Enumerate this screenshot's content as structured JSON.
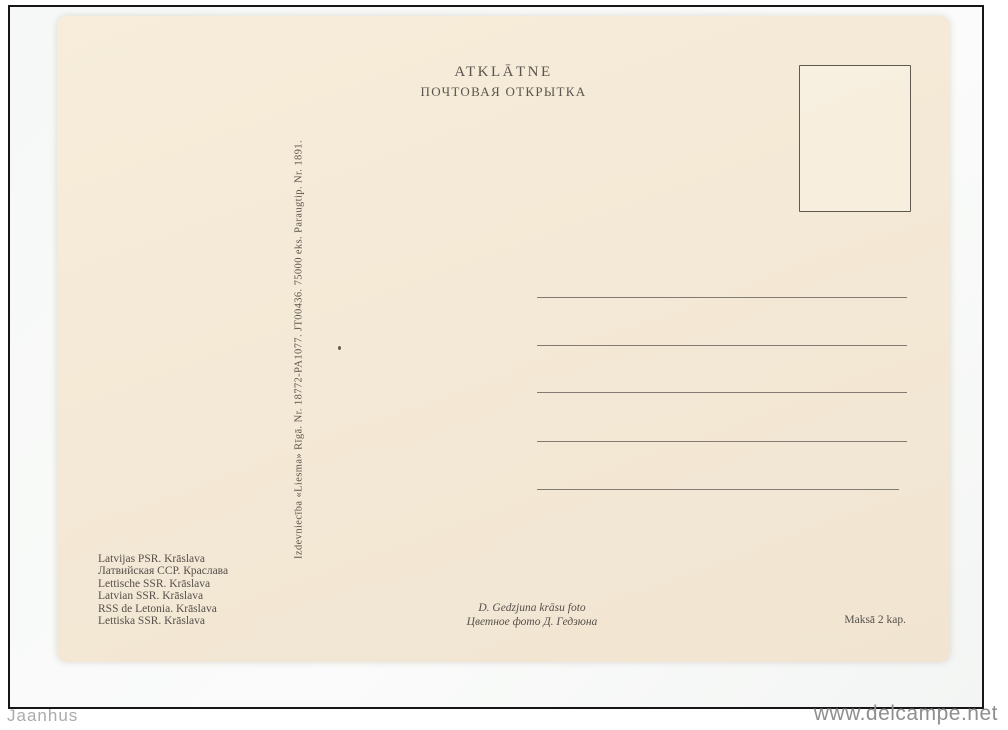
{
  "watermark": {
    "left": "Jaanhus",
    "right": "www.delcampe.net"
  },
  "postcard": {
    "header": {
      "title_latvian": "ATKLĀTNE",
      "title_russian": "ПОЧТОВАЯ ОТКРЫТКА"
    },
    "publisher_imprint": "Izdevniecība «Liesma» Rīgā.  Nr. 18772-PA1077.  JT00436.  75000 eks.  Paraugtip.  Nr. 1891.",
    "captions": {
      "lines": [
        "Latvijas PSR. Krāslava",
        "Латвийская ССР. Краслава",
        "Lettische SSR. Krāslava",
        "Latvian SSR. Krāslava",
        "RSS de Letonia. Krāslava",
        "Lettiska SSR. Krāslava"
      ]
    },
    "photo_credit": {
      "line1": "D. Gedzjuna krāsu foto",
      "line2": "Цветное фото Д. Гедзюна"
    },
    "price": "Maksā 2 kap.",
    "address_lines_count": 5
  },
  "colors": {
    "card_background": "#f4e9d6",
    "ink": "#55504a",
    "address_line": "#6e675f",
    "frame_border": "#161616",
    "watermark_text": "#9b9b9b"
  }
}
